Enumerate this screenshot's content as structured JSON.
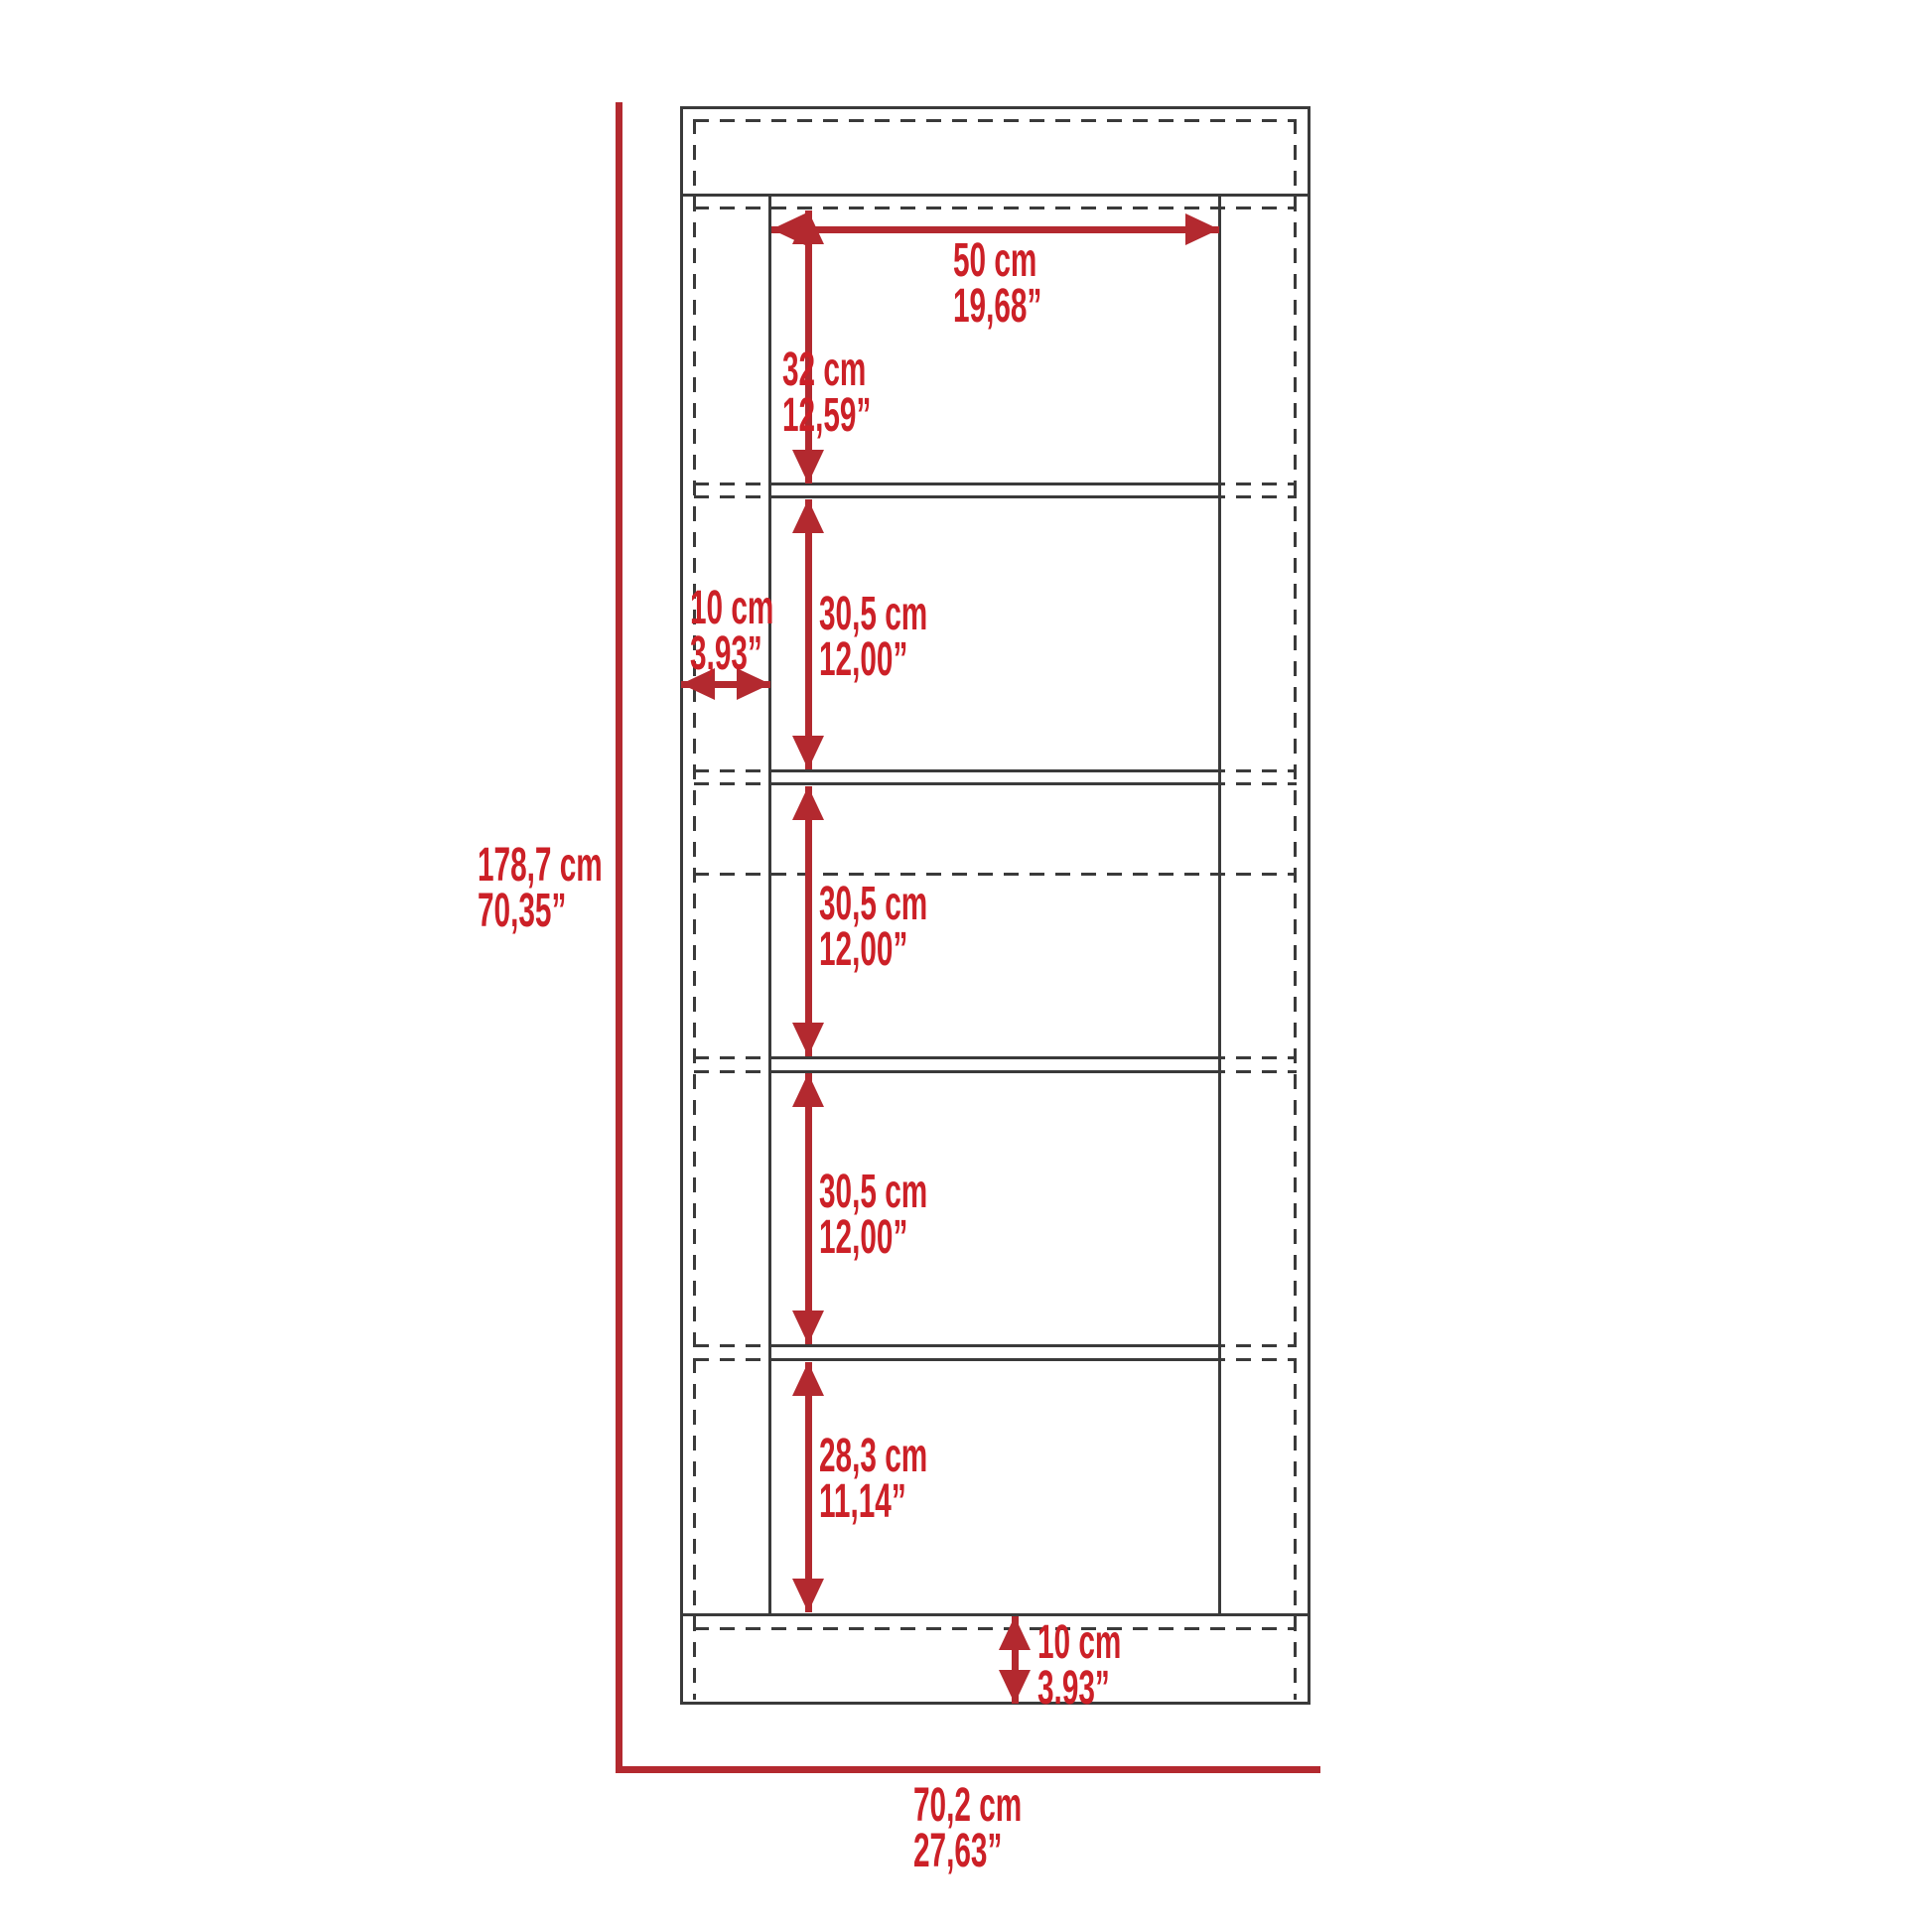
{
  "diagram": {
    "title": "Bookcase dimension drawing",
    "colors": {
      "label_red": "#cc2027",
      "arrow_red": "#b3292f",
      "line_dark": "#3a3a3a",
      "background": "#ffffff"
    },
    "labels": {
      "height_total": {
        "metric": "178,7 cm",
        "imperial": "70,35”"
      },
      "width_total": {
        "metric": "70,2 cm",
        "imperial": "27,63”"
      },
      "inner_width": {
        "metric": "50 cm",
        "imperial": "19,68”"
      },
      "section_top": {
        "metric": "32 cm",
        "imperial": "12,59”"
      },
      "side_thickness": {
        "metric": "10 cm",
        "imperial": "3,93”"
      },
      "section_2": {
        "metric": "30,5 cm",
        "imperial": "12,00”"
      },
      "section_3": {
        "metric": "30,5 cm",
        "imperial": "12,00”"
      },
      "section_4": {
        "metric": "30,5 cm",
        "imperial": "12,00”"
      },
      "section_bottom": {
        "metric": "28,3 cm",
        "imperial": "11,14”"
      },
      "base_height": {
        "metric": "10 cm",
        "imperial": "3.93”"
      }
    }
  }
}
